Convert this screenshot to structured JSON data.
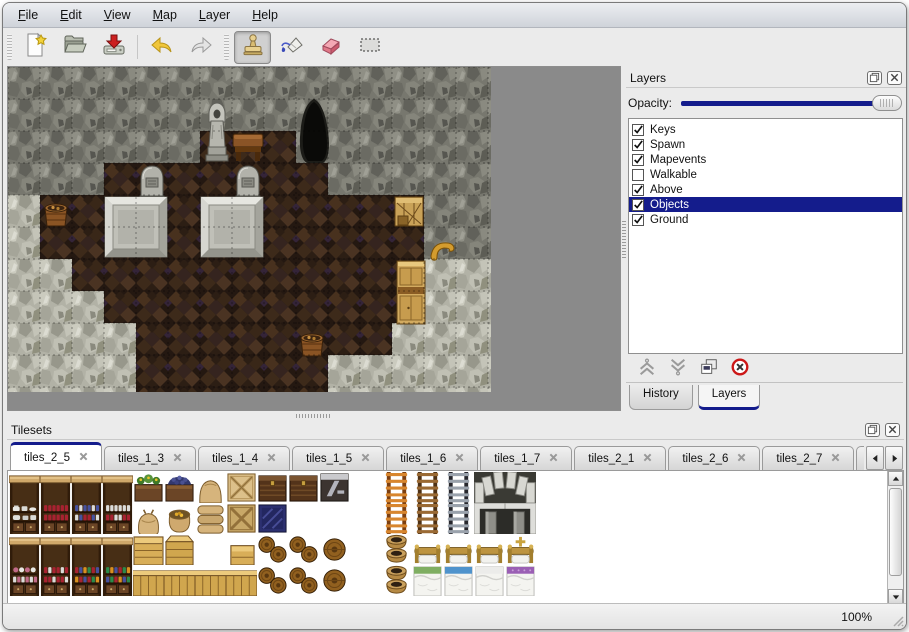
{
  "menu": {
    "items": [
      "File",
      "Edit",
      "View",
      "Map",
      "Layer",
      "Help"
    ]
  },
  "toolbar": {
    "file_buttons": [
      "new-file",
      "open",
      "save"
    ],
    "edit_buttons": [
      "undo",
      "redo"
    ],
    "tool_buttons": [
      "stamp-tool",
      "fill-tool",
      "eraser-tool",
      "select-tool"
    ],
    "active_tool": "stamp-tool"
  },
  "map_view": {
    "tile_size": 32,
    "grid": [
      "WWWWWWWWWWWWWWW",
      "WWWWWWWWWCWWWWW",
      "WWWWWWFFFCWWWWW",
      "WWWFFFFFFFWWWWW",
      "RFFFFFFFFFFFFWW",
      "RFFFFFFFFFFFFWW",
      "RRFFFFFFFFFFFRR",
      "RRRFFFFFFFFFFRR",
      "RRRRFFFFFFFFRRR",
      "RRRRFFFFFFRRRRR"
    ],
    "objects": [
      {
        "kind": "cave",
        "x": 283,
        "y": 30
      },
      {
        "kind": "statue",
        "x": 193,
        "y": 32
      },
      {
        "kind": "table",
        "x": 224,
        "y": 63
      },
      {
        "kind": "grave",
        "x": 128,
        "y": 97
      },
      {
        "kind": "grave",
        "x": 224,
        "y": 97
      },
      {
        "kind": "slab",
        "x": 97,
        "y": 130
      },
      {
        "kind": "slab",
        "x": 193,
        "y": 130
      },
      {
        "kind": "barrel-bucket",
        "x": 33,
        "y": 131
      },
      {
        "kind": "crate-open",
        "x": 386,
        "y": 127
      },
      {
        "kind": "horn",
        "x": 421,
        "y": 173
      },
      {
        "kind": "cabinet",
        "x": 388,
        "y": 193
      },
      {
        "kind": "barrel-bucket",
        "x": 289,
        "y": 261
      }
    ]
  },
  "layers_panel": {
    "title": "Layers",
    "opacity_label": "Opacity:",
    "opacity_percent": 100,
    "layers": [
      {
        "name": "Keys",
        "checked": true,
        "selected": false
      },
      {
        "name": "Spawn",
        "checked": true,
        "selected": false
      },
      {
        "name": "Mapevents",
        "checked": true,
        "selected": false
      },
      {
        "name": "Walkable",
        "checked": false,
        "selected": false
      },
      {
        "name": "Above",
        "checked": true,
        "selected": false
      },
      {
        "name": "Objects",
        "checked": true,
        "selected": true
      },
      {
        "name": "Ground",
        "checked": true,
        "selected": false
      }
    ],
    "action_buttons": [
      "move-layer-up",
      "move-layer-down",
      "duplicate-layer",
      "delete-layer"
    ],
    "tabs": [
      {
        "label": "History",
        "active": false
      },
      {
        "label": "Layers",
        "active": true
      }
    ]
  },
  "tilesets_panel": {
    "title": "Tilesets",
    "tabs": [
      {
        "label": "tiles_2_5",
        "active": true,
        "partial": false
      },
      {
        "label": "tiles_1_3",
        "active": false,
        "partial": false
      },
      {
        "label": "tiles_1_4",
        "active": false,
        "partial": false
      },
      {
        "label": "tiles_1_5",
        "active": false,
        "partial": false
      },
      {
        "label": "tiles_1_6",
        "active": false,
        "partial": false
      },
      {
        "label": "tiles_1_7",
        "active": false,
        "partial": false
      },
      {
        "label": "tiles_2_1",
        "active": false,
        "partial": false
      },
      {
        "label": "tiles_2_6",
        "active": false,
        "partial": false
      },
      {
        "label": "tiles_2_7",
        "active": false,
        "partial": false
      },
      {
        "label": "tiles_",
        "active": false,
        "partial": true
      }
    ],
    "tiles": [
      [
        "shelf_top",
        "shelf_top",
        "shelf_top",
        "shelf_top",
        "flower_box",
        "grape_box",
        "sack_top",
        "crate_x",
        "chest",
        "chest",
        "chest_z",
        "empty",
        "ladder_orange",
        "ladder_brown",
        "ladder_gray",
        "arch_left",
        "arch_right"
      ],
      [
        "shelf_dishes",
        "shelf_red",
        "shelf_blue",
        "shelf_jars",
        "sack",
        "sack_open",
        "sack_pile",
        "crate_x2",
        "crate_blue",
        "empty",
        "empty",
        "empty",
        "ladder_orange",
        "ladder_brown",
        "ladder_gray",
        "hearth_left",
        "hearth_right"
      ],
      [
        "shelf_top",
        "shelf_top",
        "shelf_top",
        "shelf_top",
        "crate_big",
        "crate_lid",
        "empty",
        "crate_small",
        "barrels2",
        "barrels2",
        "barrel",
        "empty",
        "pot_stack",
        "bed_head",
        "bed_head",
        "bed_head",
        "bed_head_x"
      ],
      [
        "shelf_jam",
        "shelf_books",
        "shelf_bottles",
        "shelf_booksm",
        "crate_row",
        "crate_row",
        "crate_row",
        "crate_row",
        "barrels2",
        "barrels2",
        "barrel",
        "empty",
        "pot_stack",
        "bed_green",
        "bed_blue",
        "bed_white",
        "bed_purple"
      ]
    ]
  },
  "status_bar": {
    "zoom_level": "100%"
  },
  "colors": {
    "accent_navy": "#141c8c",
    "selection_bg": "#141c8c",
    "map_background": "#8a8a8a",
    "panel_background": "#ebebeb"
  }
}
